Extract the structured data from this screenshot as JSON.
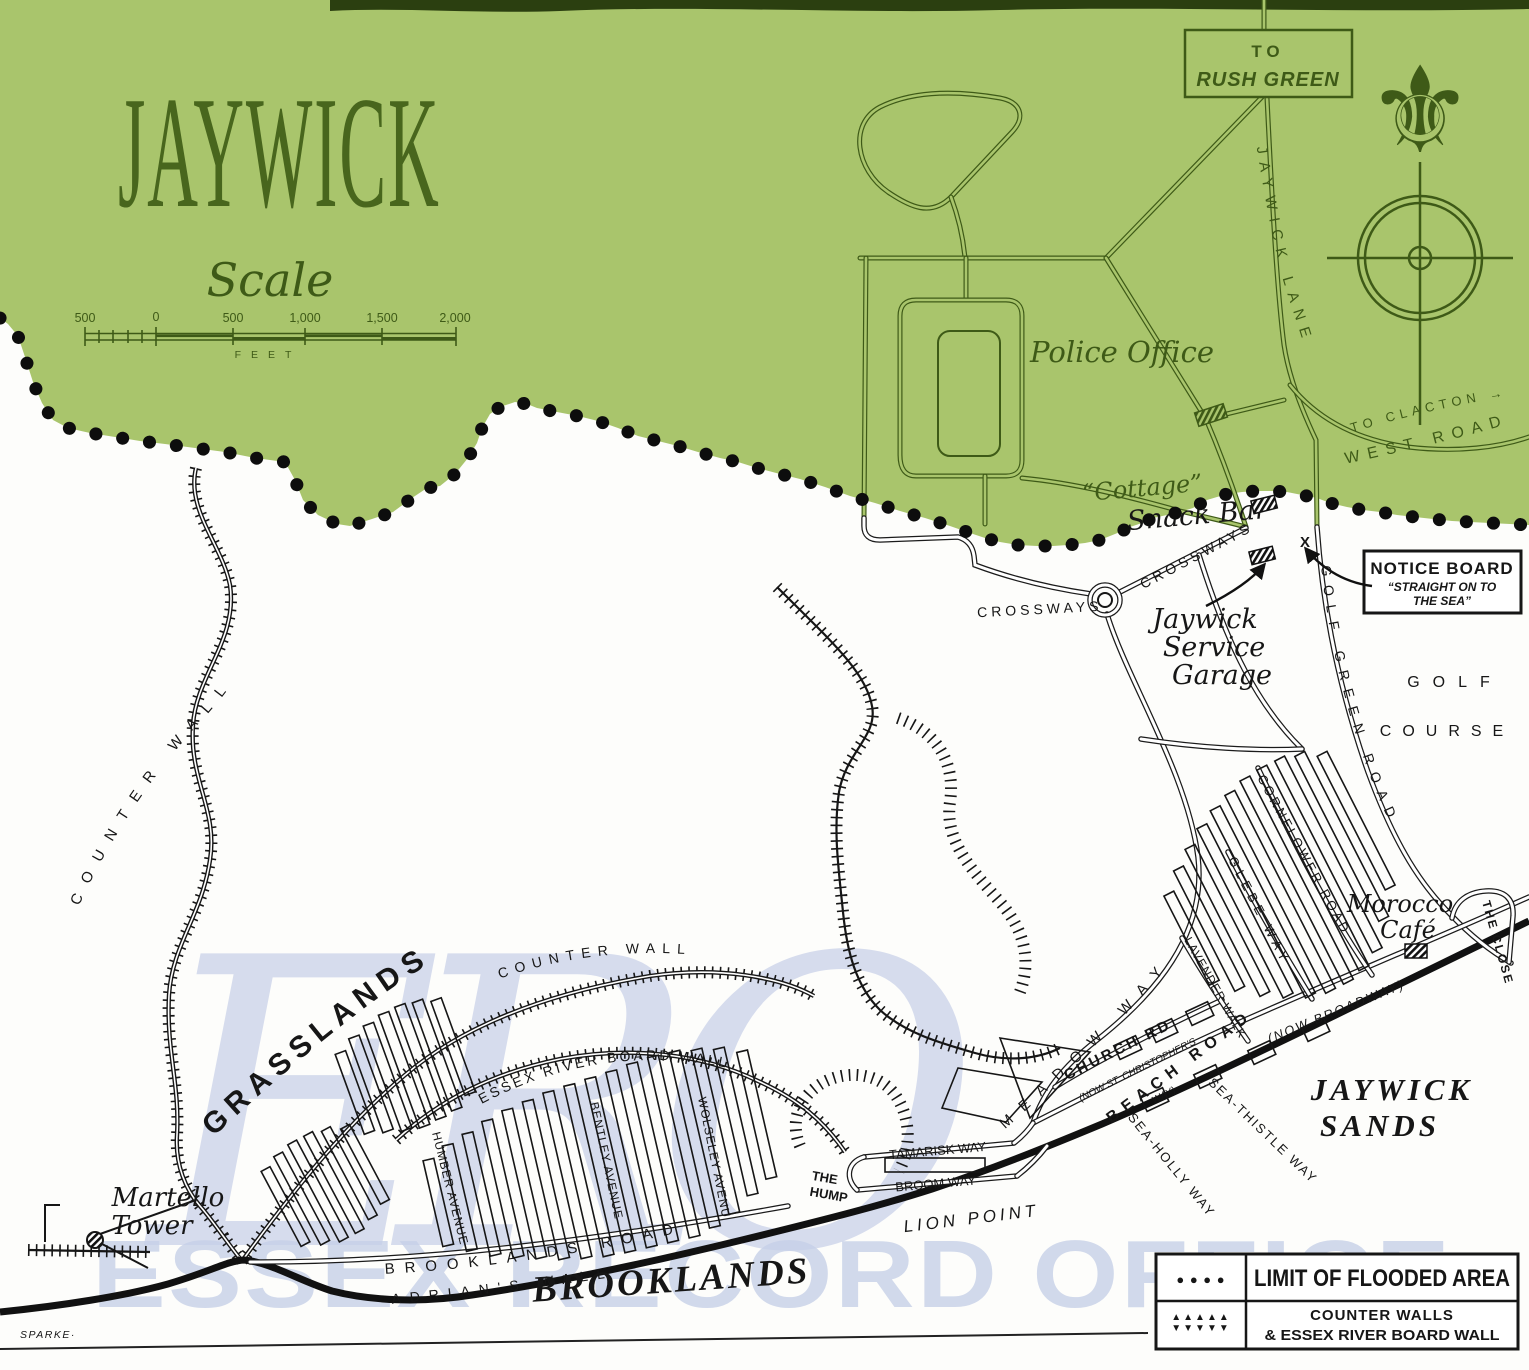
{
  "colors": {
    "unflooded_green": "#a9c56c",
    "green_ink": "#3e5a17",
    "black_ink": "#161616",
    "paper": "#fdfdfb",
    "watermark_blue": "#c6cfe7",
    "title_green": "#48661d"
  },
  "title": "JAYWICK",
  "scale": {
    "label": "Scale",
    "unit": "FEET",
    "ticks": [
      "500",
      "0",
      "500",
      "1,000",
      "1,500",
      "2,000"
    ]
  },
  "signs": {
    "rush_green_to": "TO",
    "rush_green_name": "RUSH GREEN",
    "notice_title": "NOTICE BOARD",
    "notice_line1": "“STRAIGHT ON TO",
    "notice_line2": "THE SEA”",
    "x_marker": "X"
  },
  "roads": {
    "jaywick_lane": "JAYWICK LANE",
    "west_road": "WEST ROAD",
    "to_clacton": "TO CLACTON →",
    "crossways_w": "CROSSWAYS",
    "crossways_e": "CROSSWAYS",
    "golf_green_road": "GOLF GREEN ROAD",
    "meadow_way": "MEADOW WAY",
    "church_rd": "CHURCH RD",
    "church_rd_note": "(NOW ST. CHRISTOPHER'S",
    "church_rd_note2": "WAY)",
    "beach_road": "BEACH ROAD",
    "beach_road_note": "(NOW BROADWAY)",
    "sea_holly_way": "SEA-HOLLY WAY",
    "sea_thistle_way": "SEA-THISTLE WAY",
    "lavender_walk": "LAVENDER WALK",
    "glebe_way": "GLEBE WAY",
    "cornflower_road": "CORNFLOWER ROAD",
    "the_close": "THE CLOSE",
    "humber_avenue": "HUMBER AVENUE",
    "bentley_avenue": "BENTLEY AVENUE",
    "wolseley_avenue": "WOLSELEY AVENUE",
    "brooklands_road": "BROOKLANDS ROAD",
    "tamarisk_way": "TAMARISK WAY",
    "broom_way": "BROOM WAY"
  },
  "places": {
    "police_office": "Police Office",
    "cottage": "“Cottage”",
    "snack_bar": "Snack Bar",
    "garage_1": "Jaywick",
    "garage_2": "Service",
    "garage_3": "Garage",
    "golf_1": "GOLF",
    "golf_2": "COURSE",
    "morocco_1": "Morocco",
    "morocco_2": "Café",
    "martello_1": "Martello",
    "martello_2": "Tower",
    "grasslands": "GRASSLANDS",
    "brooklands": "BROOKLANDS",
    "jaywick_sands_1": "JAYWICK",
    "jaywick_sands_2": "SANDS",
    "the_hump_1": "THE",
    "the_hump_2": "HUMP",
    "lion_point": "LION POINT"
  },
  "walls": {
    "counter_wall_w": "COUNTER WALL",
    "counter_wall_s": "COUNTER WALL",
    "essex_wall": "ESSEX RIVER BOARD WALL",
    "adrians_wall": "ADRIAN'S WALL"
  },
  "legend": {
    "row1": "LIMIT OF FLOODED AREA",
    "row2a": "COUNTER WALLS",
    "row2b": "& ESSEX RIVER BOARD WALL",
    "dots": "● ● ● ●",
    "hatch_up": "▲▲▲▲▲",
    "hatch_down": "▼▼▼▼▼"
  },
  "watermark": {
    "monogram": "ERO",
    "text": "ESSEX RECORD OFFICE"
  },
  "credit": "SPARKE·"
}
